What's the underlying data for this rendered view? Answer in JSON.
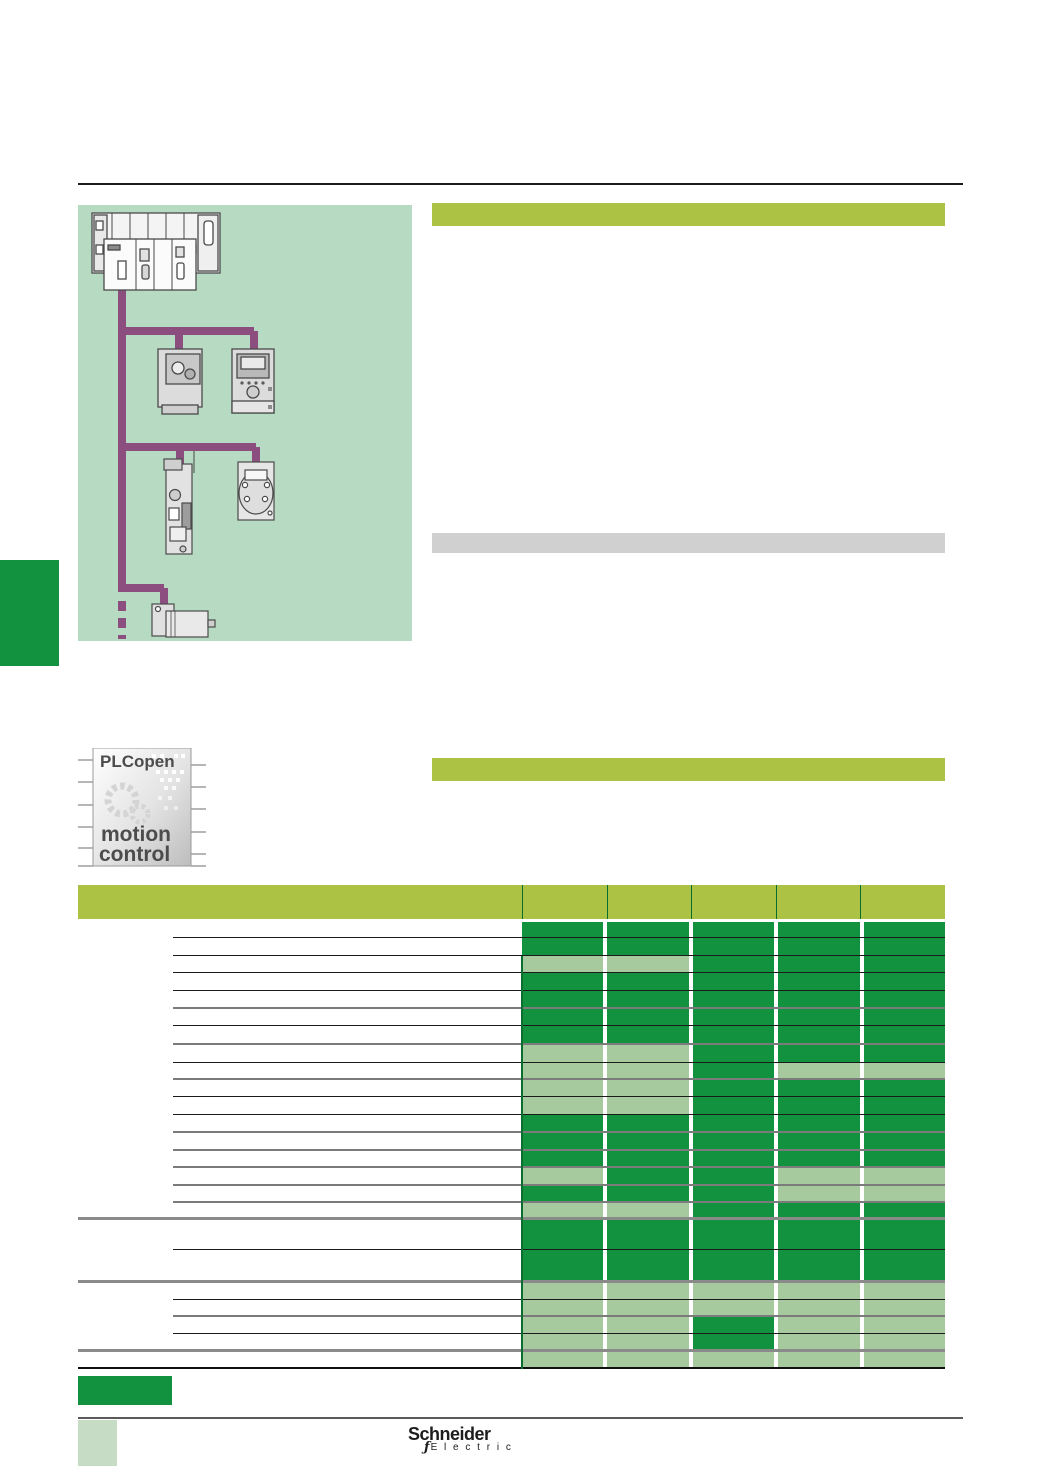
{
  "colors": {
    "lime": "#abc245",
    "dark_green": "#12923f",
    "light_green": "#a6ca9e",
    "image_bg": "#b7dbc2",
    "network_purple": "#8b4e7f",
    "gray_bar": "#d0d0d0"
  },
  "branding": {
    "plcopen": {
      "line1": "PLCopen",
      "line2": "motion",
      "line3": "control"
    },
    "schneider": {
      "name": "Schneider",
      "glyph": "ƒ",
      "sub": "E l e c t r i c"
    }
  },
  "table": {
    "column_count": 5,
    "cell_states": [
      "dark",
      "light"
    ],
    "rows": [
      {
        "h": 16,
        "cells": [
          "dark",
          "dark",
          "dark",
          "dark",
          "dark"
        ],
        "rule": "thin"
      },
      {
        "h": 18,
        "cells": [
          "dark",
          "dark",
          "dark",
          "dark",
          "dark"
        ],
        "rule": "thin"
      },
      {
        "h": 17,
        "cells": [
          "light",
          "light",
          "dark",
          "dark",
          "dark"
        ],
        "rule": "thin"
      },
      {
        "h": 18,
        "cells": [
          "dark",
          "dark",
          "dark",
          "dark",
          "dark"
        ],
        "rule": "thin"
      },
      {
        "h": 18,
        "cells": [
          "dark",
          "dark",
          "dark",
          "dark",
          "dark"
        ],
        "rule": "thick"
      },
      {
        "h": 17,
        "cells": [
          "dark",
          "dark",
          "dark",
          "dark",
          "dark"
        ],
        "rule": "thin"
      },
      {
        "h": 19,
        "cells": [
          "dark",
          "dark",
          "dark",
          "dark",
          "dark"
        ],
        "rule": "thick"
      },
      {
        "h": 18,
        "cells": [
          "light",
          "light",
          "dark",
          "dark",
          "dark"
        ],
        "rule": "thin"
      },
      {
        "h": 17,
        "cells": [
          "light",
          "light",
          "dark",
          "light",
          "light"
        ],
        "rule": "thick"
      },
      {
        "h": 17,
        "cells": [
          "light",
          "light",
          "dark",
          "dark",
          "dark"
        ],
        "rule": "thin"
      },
      {
        "h": 18,
        "cells": [
          "light",
          "light",
          "dark",
          "dark",
          "dark"
        ],
        "rule": "thin"
      },
      {
        "h": 18,
        "cells": [
          "dark",
          "dark",
          "dark",
          "dark",
          "dark"
        ],
        "rule": "thick"
      },
      {
        "h": 18,
        "cells": [
          "dark",
          "dark",
          "dark",
          "dark",
          "dark"
        ],
        "rule": "thick"
      },
      {
        "h": 17,
        "cells": [
          "dark",
          "dark",
          "dark",
          "dark",
          "dark"
        ],
        "rule": "thick"
      },
      {
        "h": 18,
        "cells": [
          "light",
          "dark",
          "dark",
          "light",
          "light"
        ],
        "rule": "thick"
      },
      {
        "h": 17,
        "cells": [
          "dark",
          "dark",
          "dark",
          "light",
          "light"
        ],
        "rule": "thick"
      },
      {
        "h": 17,
        "cells": [
          "light",
          "light",
          "dark",
          "dark",
          "dark"
        ],
        "rule": "section"
      },
      {
        "h": 30,
        "cells": [
          "dark",
          "dark",
          "dark",
          "dark",
          "dark"
        ],
        "rule": "thin"
      },
      {
        "h": 33,
        "cells": [
          "dark",
          "dark",
          "dark",
          "dark",
          "dark"
        ],
        "rule": "section"
      },
      {
        "h": 17,
        "cells": [
          "light",
          "light",
          "light",
          "light",
          "light"
        ],
        "rule": "thin"
      },
      {
        "h": 17,
        "cells": [
          "light",
          "light",
          "light",
          "light",
          "light"
        ],
        "rule": "thick"
      },
      {
        "h": 17,
        "cells": [
          "light",
          "light",
          "dark",
          "light",
          "light"
        ],
        "rule": "thin"
      },
      {
        "h": 18,
        "cells": [
          "light",
          "light",
          "dark",
          "light",
          "light"
        ],
        "rule": "section"
      },
      {
        "h": 17,
        "cells": [
          "light",
          "light",
          "light",
          "light",
          "light"
        ],
        "rule": "bottom"
      }
    ]
  }
}
